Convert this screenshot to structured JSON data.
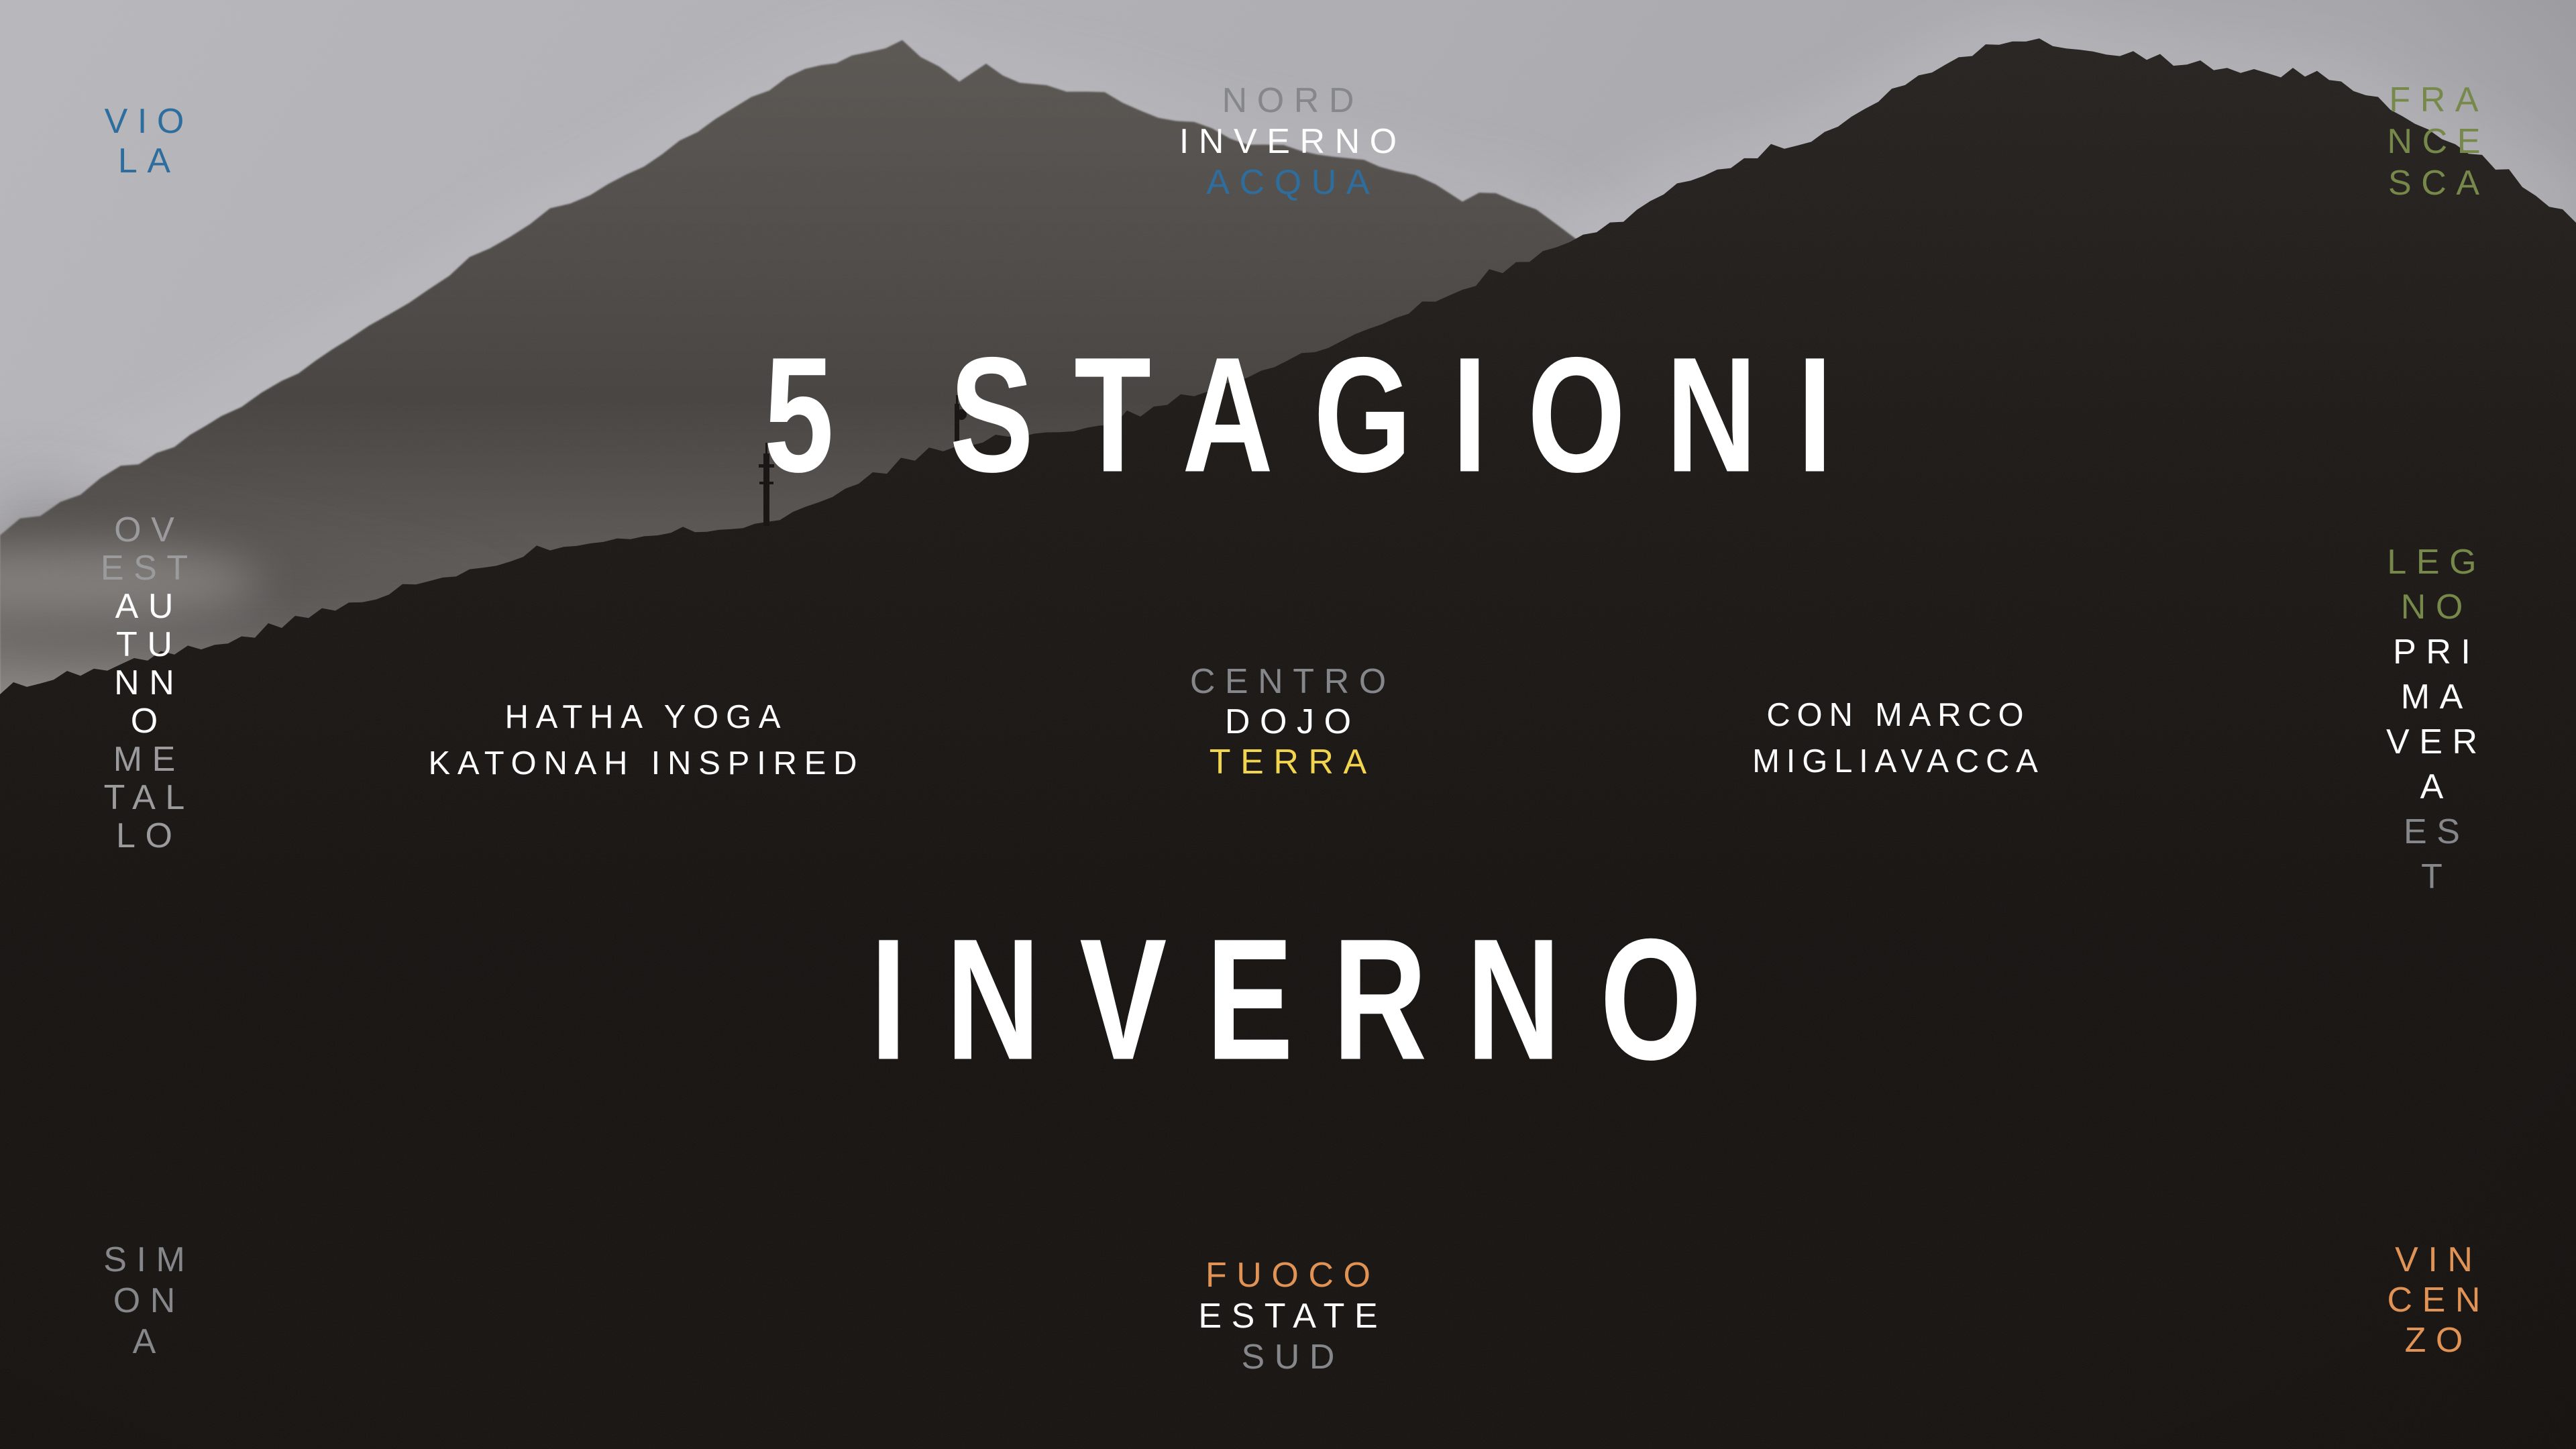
{
  "poster": {
    "title": "5 STAGIONI",
    "subtitle": "INVERNO",
    "colors": {
      "blue": "#2e6e9e",
      "green": "#76894a",
      "yellow": "#f2d54e",
      "orange": "#e09355",
      "gray": "#85878a",
      "gray_light": "#9b9b9d",
      "white": "#fdfdfd"
    },
    "blocks": {
      "top_left_name": {
        "lines": [
          {
            "t": "VIO",
            "tone": "blue"
          },
          {
            "t": "LA",
            "tone": "blue"
          }
        ]
      },
      "top_center_compass": {
        "lines": [
          {
            "t": "NORD",
            "tone": "gray"
          },
          {
            "t": "INVERNO",
            "tone": "white"
          },
          {
            "t": "ACQUA",
            "tone": "blue"
          }
        ]
      },
      "top_right_name": {
        "lines": [
          {
            "t": "FRA",
            "tone": "green"
          },
          {
            "t": "NCE",
            "tone": "green"
          },
          {
            "t": "SCA",
            "tone": "green"
          }
        ]
      },
      "left_column": {
        "lines": [
          {
            "t": "OV",
            "tone": "gray2"
          },
          {
            "t": "EST",
            "tone": "gray2"
          },
          {
            "t": "AU",
            "tone": "white"
          },
          {
            "t": "TU",
            "tone": "white"
          },
          {
            "t": "NN",
            "tone": "white"
          },
          {
            "t": "O",
            "tone": "white"
          },
          {
            "t": "ME",
            "tone": "gray2"
          },
          {
            "t": "TAL",
            "tone": "gray2"
          },
          {
            "t": "LO",
            "tone": "gray2"
          }
        ]
      },
      "right_column": {
        "lines": [
          {
            "t": "LEG",
            "tone": "green"
          },
          {
            "t": "NO",
            "tone": "green"
          },
          {
            "t": "PRI",
            "tone": "white"
          },
          {
            "t": "MA",
            "tone": "white"
          },
          {
            "t": "VER",
            "tone": "white"
          },
          {
            "t": "A",
            "tone": "white"
          },
          {
            "t": "ES",
            "tone": "gray"
          },
          {
            "t": "T",
            "tone": "gray"
          }
        ]
      },
      "class_info": {
        "lines": [
          {
            "t": "HATHA YOGA",
            "tone": "white"
          },
          {
            "t": "KATONAH INSPIRED",
            "tone": "white"
          }
        ]
      },
      "center_compass": {
        "lines": [
          {
            "t": "CENTRO",
            "tone": "gray"
          },
          {
            "t": "DOJO",
            "tone": "white"
          },
          {
            "t": "TERRA",
            "tone": "yellow"
          }
        ]
      },
      "teacher_info": {
        "lines": [
          {
            "t": "CON MARCO",
            "tone": "white"
          },
          {
            "t": "MIGLIAVACCA",
            "tone": "white"
          }
        ]
      },
      "bottom_center_compass": {
        "lines": [
          {
            "t": "FUOCO",
            "tone": "orange"
          },
          {
            "t": "ESTATE",
            "tone": "white"
          },
          {
            "t": "SUD",
            "tone": "gray"
          }
        ]
      },
      "bottom_left_name": {
        "lines": [
          {
            "t": "SIM",
            "tone": "gray"
          },
          {
            "t": "ON",
            "tone": "gray"
          },
          {
            "t": "A",
            "tone": "gray"
          }
        ]
      },
      "bottom_right_name": {
        "lines": [
          {
            "t": "VIN",
            "tone": "orange"
          },
          {
            "t": "CEN",
            "tone": "orange"
          },
          {
            "t": "ZO",
            "tone": "orange"
          }
        ]
      }
    }
  }
}
